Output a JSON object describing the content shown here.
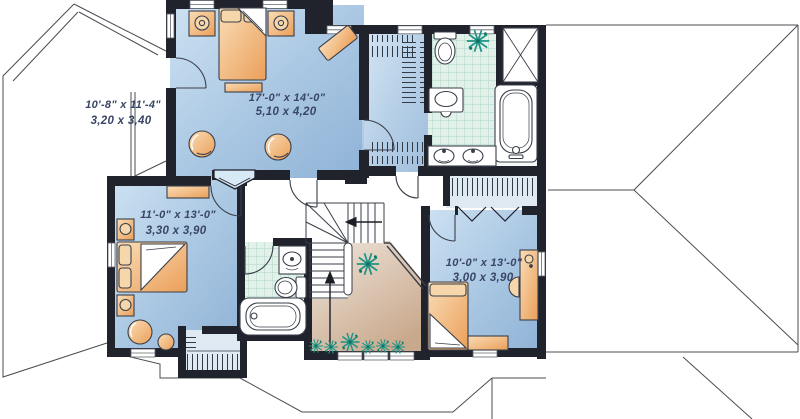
{
  "plan": {
    "title": "second floor plan",
    "rooms": [
      {
        "name": "attic-storage",
        "imperial": "10'-8\" x 11'-4\"",
        "metric": "3,20 x 3,40"
      },
      {
        "name": "master-bedroom",
        "imperial": "17'-0\" x 14'-0\"",
        "metric": "5,10 x 4,20"
      },
      {
        "name": "bedroom-2",
        "imperial": "11'-0\" x 13'-0\"",
        "metric": "3,30 x 3,90"
      },
      {
        "name": "bedroom-3",
        "imperial": "10'-0\" x 13'-0\"",
        "metric": "3,00 x 3,90"
      }
    ],
    "colors": {
      "wall": "#20222c",
      "room_blue_light": "#c9def1",
      "room_blue_dark": "#8fb2d6",
      "tile_green": "#e2f1e9",
      "tile_grid": "#aed7c6",
      "open_below_light": "#eee4da",
      "open_below_dark": "#c9a98d",
      "furniture_light": "#f9ddb6",
      "furniture_dark": "#eb9f5a",
      "plant": "#1f9486",
      "label_text": "#3a4666",
      "roof_line": "#4a4d52"
    }
  }
}
